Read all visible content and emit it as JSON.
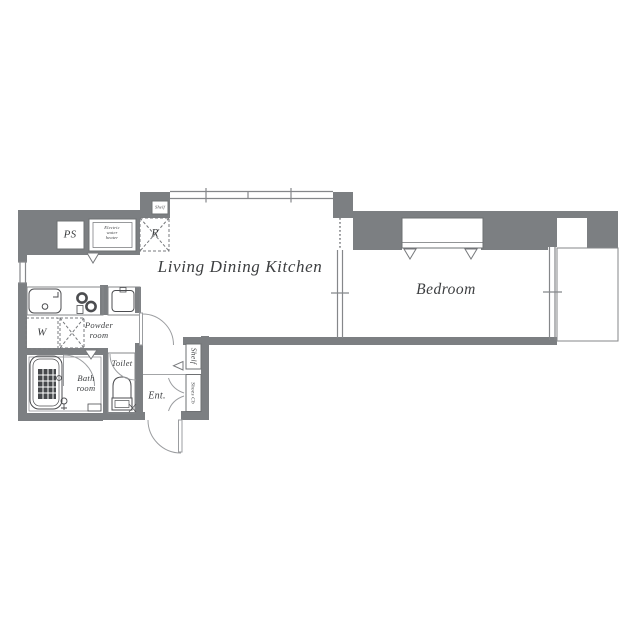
{
  "document": {
    "type": "apartment-floor-plan",
    "style": "japanese-real-estate-madori"
  },
  "labels": {
    "living_dining_kitchen": "Living Dining Kitchen",
    "bedroom": "Bedroom",
    "ps": "PS",
    "refrigerator": "R",
    "washer": "W",
    "toilet": "Toilet",
    "entrance": "Ent.",
    "shelf_kitchen": "Shelf",
    "shelf_hall": "Shelf",
    "shoes_cabinet": "Shoes Cb",
    "water_heater": [
      "Electric",
      "water",
      "heater"
    ],
    "powder_room": [
      "Powder",
      "room"
    ],
    "bath_room": [
      "Bath",
      "room"
    ]
  },
  "colors": {
    "background": "#ffffff",
    "wall_fill": "#7c7f82",
    "thin_line": "#85878a",
    "door_line": "#9b9da0",
    "fixture_line": "#4c4d50",
    "tub_texture": "#46484b",
    "text": "#3c3e40"
  }
}
